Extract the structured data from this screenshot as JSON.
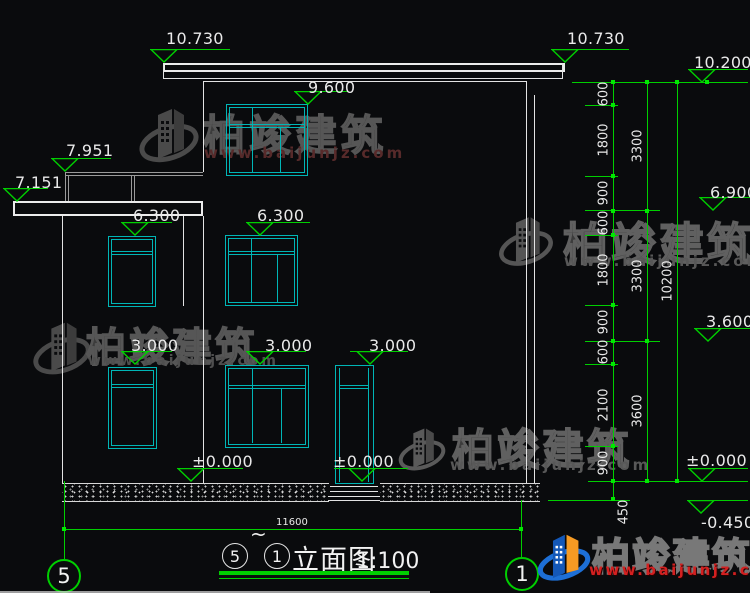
{
  "drawing": {
    "levels": [
      {
        "label": "10.730"
      },
      {
        "label": "10.730"
      },
      {
        "label": "10.200"
      },
      {
        "label": "9.600"
      },
      {
        "label": "7.951"
      },
      {
        "label": "7.151"
      },
      {
        "label": "6.300"
      },
      {
        "label": "6.300"
      },
      {
        "label": "6.900"
      },
      {
        "label": "3.600"
      },
      {
        "label": "3.000"
      },
      {
        "label": "3.000"
      },
      {
        "label": "3.000"
      },
      {
        "label": "±0.000"
      },
      {
        "label": "±0.000"
      },
      {
        "label": "±0.000"
      },
      {
        "label": "-0.450"
      }
    ],
    "dims": {
      "col1": [
        "600",
        "1800",
        "900",
        "600",
        "1800",
        "900",
        "600",
        "2100",
        "900"
      ],
      "col1_foot": "450",
      "col2": [
        "3300",
        "3300",
        "3600"
      ],
      "col3": "10200",
      "bottom": "11600"
    },
    "axes": {
      "left": "5",
      "right": "1"
    },
    "titleblock": {
      "from": "5",
      "tilde": "~",
      "to": "1",
      "name": "立面图",
      "scale": "1:100"
    }
  },
  "watermark": {
    "brand": "柏竣建筑",
    "site": "www.baijunjz.com"
  },
  "logo": {
    "brand": "柏竣建筑",
    "site": "www.baijunjz.com"
  }
}
